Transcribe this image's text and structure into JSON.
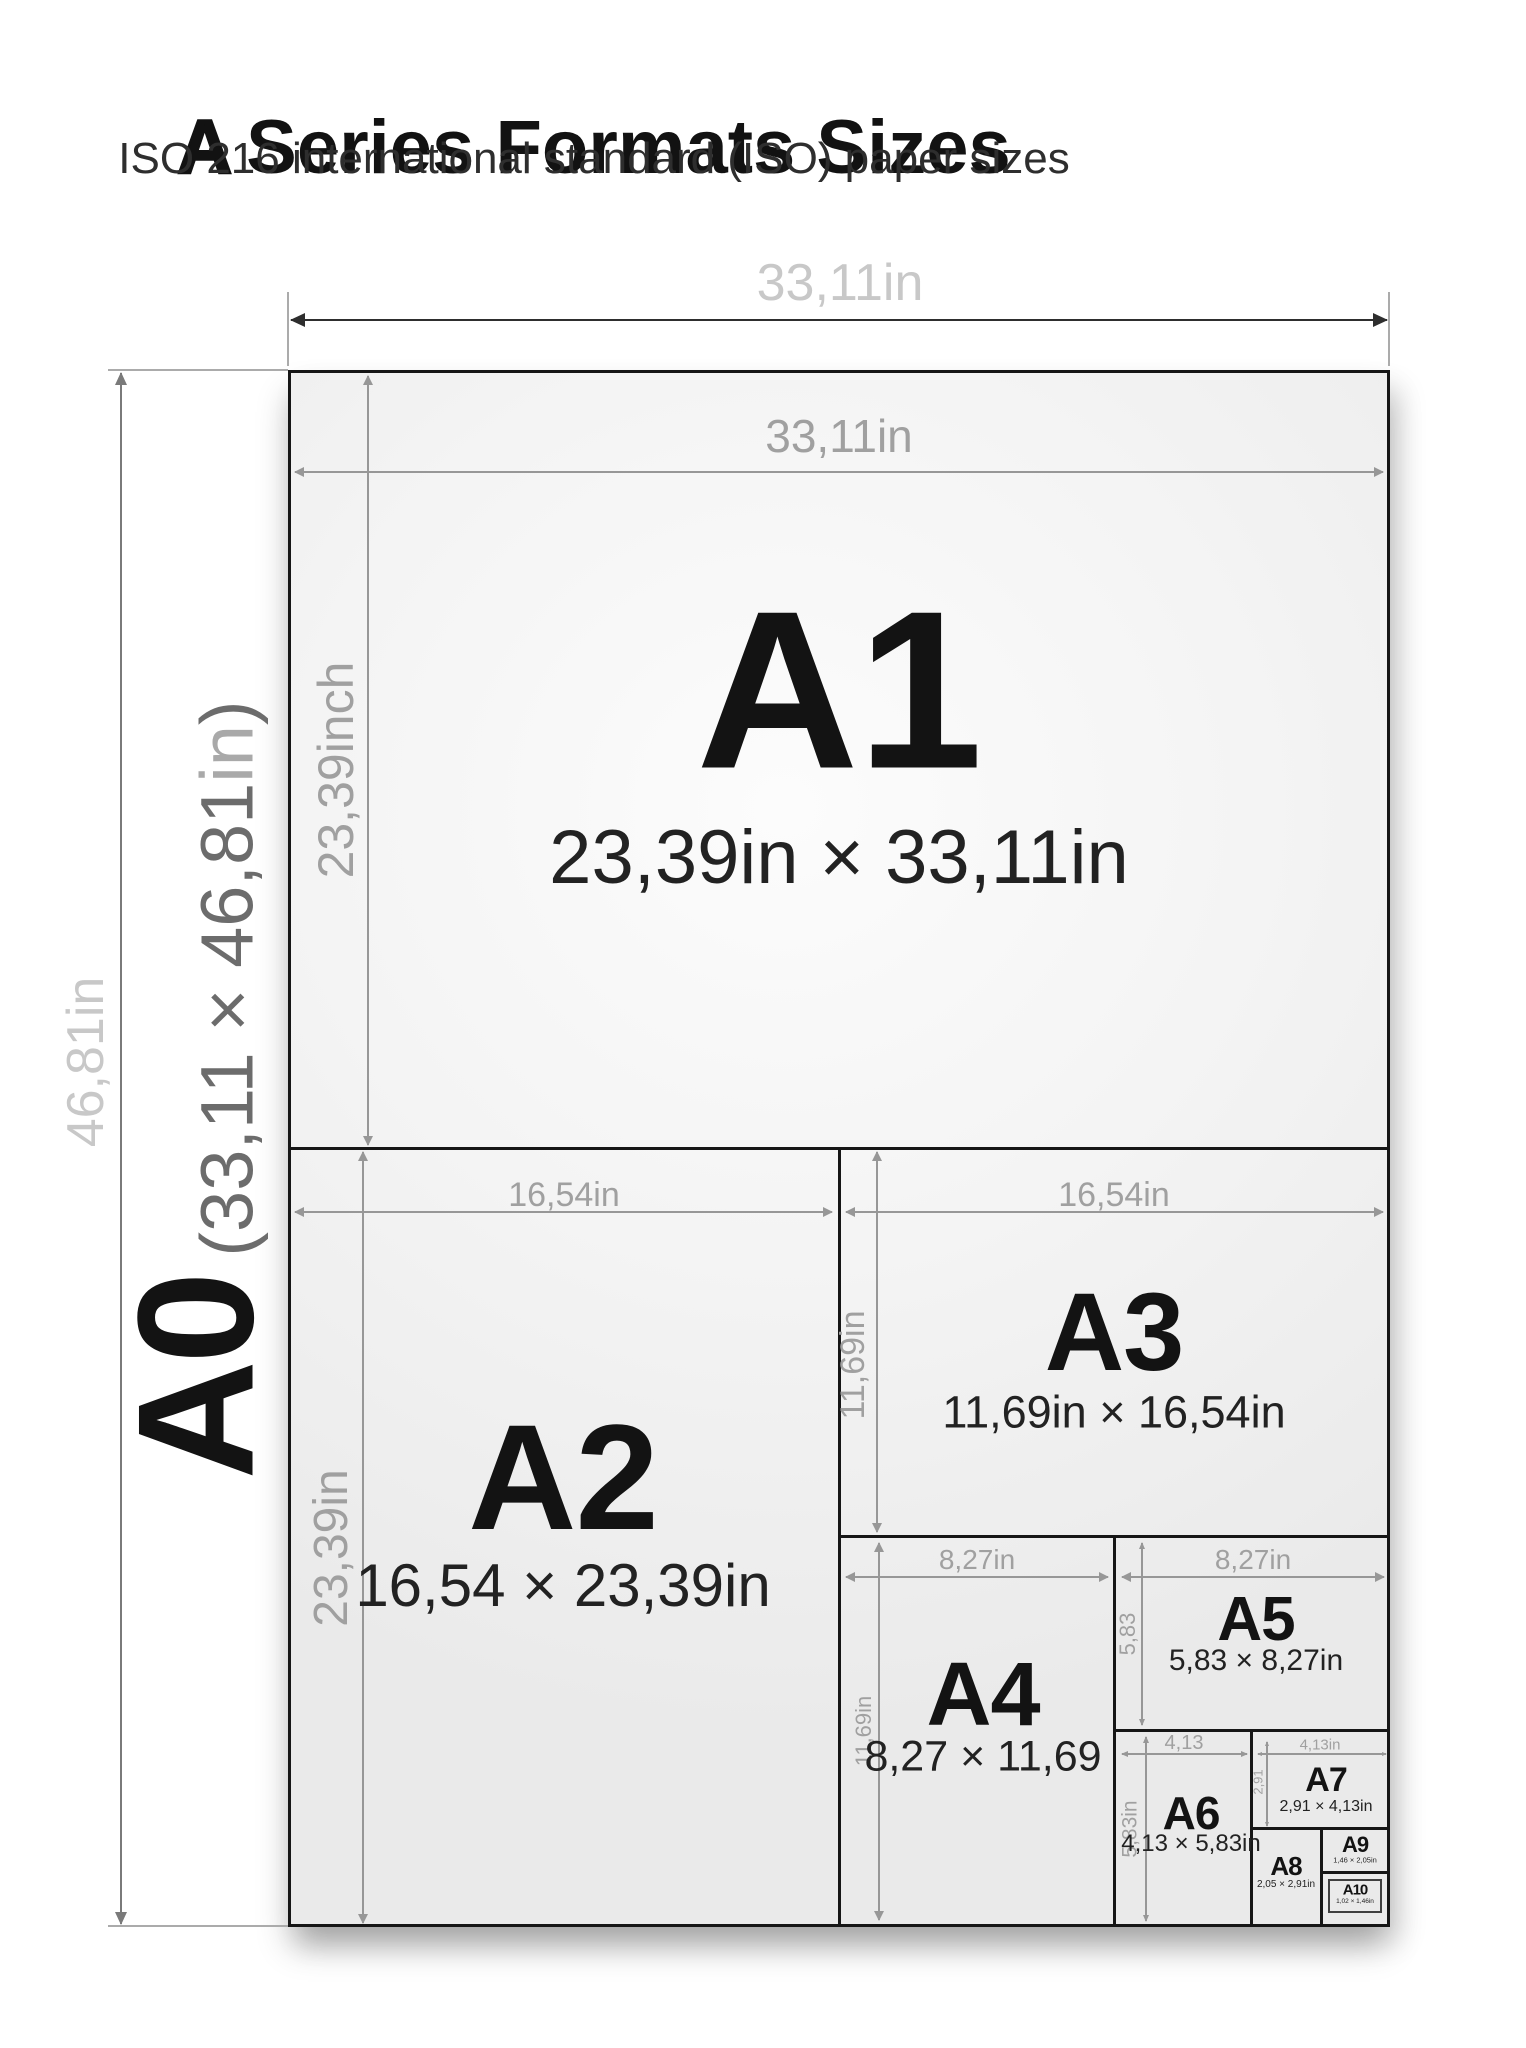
{
  "title": {
    "lead": "A",
    "rest": "Series Formats Sizes"
  },
  "subtitle": "ISO 216 international standard (ISO) paper sizes",
  "outer": {
    "top_label": "33,11in",
    "left_label": "46,81in"
  },
  "a0": {
    "name": "A0",
    "size_prefix": "(33,11 × 46,81",
    "size_unit": "in",
    "size_suffix": ")"
  },
  "sheets": {
    "a1": {
      "name": "A1",
      "size": "23,39in × 33,11in",
      "top_dim": "33,11in",
      "left_dim": "23,39inch"
    },
    "a2": {
      "name": "A2",
      "size": "16,54 × 23,39in",
      "top_dim": "16,54in",
      "left_dim": "23,39in"
    },
    "a3": {
      "name": "A3",
      "size": "11,69in × 16,54in",
      "top_dim": "16,54in",
      "left_dim": "11,69in"
    },
    "a4": {
      "name": "A4",
      "size": "8,27 × 11,69",
      "top_dim": "8,27in",
      "left_dim": "11,69in"
    },
    "a5": {
      "name": "A5",
      "size": "5,83 × 8,27in",
      "top_dim": "8,27in",
      "left_dim": "5,83"
    },
    "a6": {
      "name": "A6",
      "size": "4,13 × 5,83in",
      "top_dim": "4,13",
      "left_dim": "5,83in"
    },
    "a7": {
      "name": "A7",
      "size": "2,91 × 4,13in",
      "top_dim": "4,13in",
      "left_dim": "2,91"
    },
    "a8": {
      "name": "A8",
      "size": "2,05 × 2,91in"
    },
    "a9": {
      "name": "A9",
      "size": "1,46 × 2,05in"
    },
    "a10": {
      "name": "A10",
      "size": "1,02 × 1,46in"
    }
  },
  "colors": {
    "sheet_border": "#161616",
    "dim_line_gray": "#979797",
    "outer_label_gray": "#c8c8c8",
    "text_black": "#131313"
  }
}
